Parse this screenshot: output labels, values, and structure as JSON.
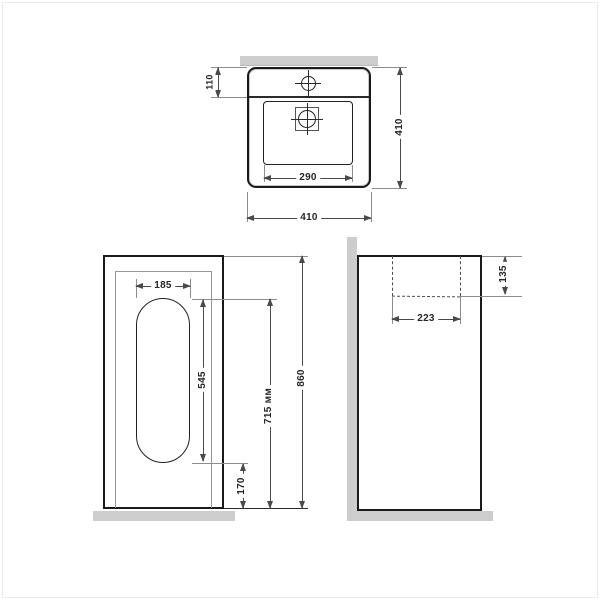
{
  "dims": {
    "plan_faucet_ledge_depth": "110",
    "plan_overall_depth": "410",
    "plan_basin_width": "290",
    "plan_overall_width": "410",
    "front_cutout_width": "185",
    "front_cutout_height": "545",
    "front_cutout_top_height": "715 мм",
    "front_overall_height": "860",
    "front_cutout_bottom_offset": "170",
    "side_rim_to_basin_drop": "135",
    "side_basin_inner_depth": "223"
  },
  "colors": {
    "outline": "#1a1a1a",
    "dimension_line": "#4a4a4a",
    "extension_line": "#8c8c8c",
    "wall_fill": "#cdcdcd",
    "background": "#ffffff"
  }
}
